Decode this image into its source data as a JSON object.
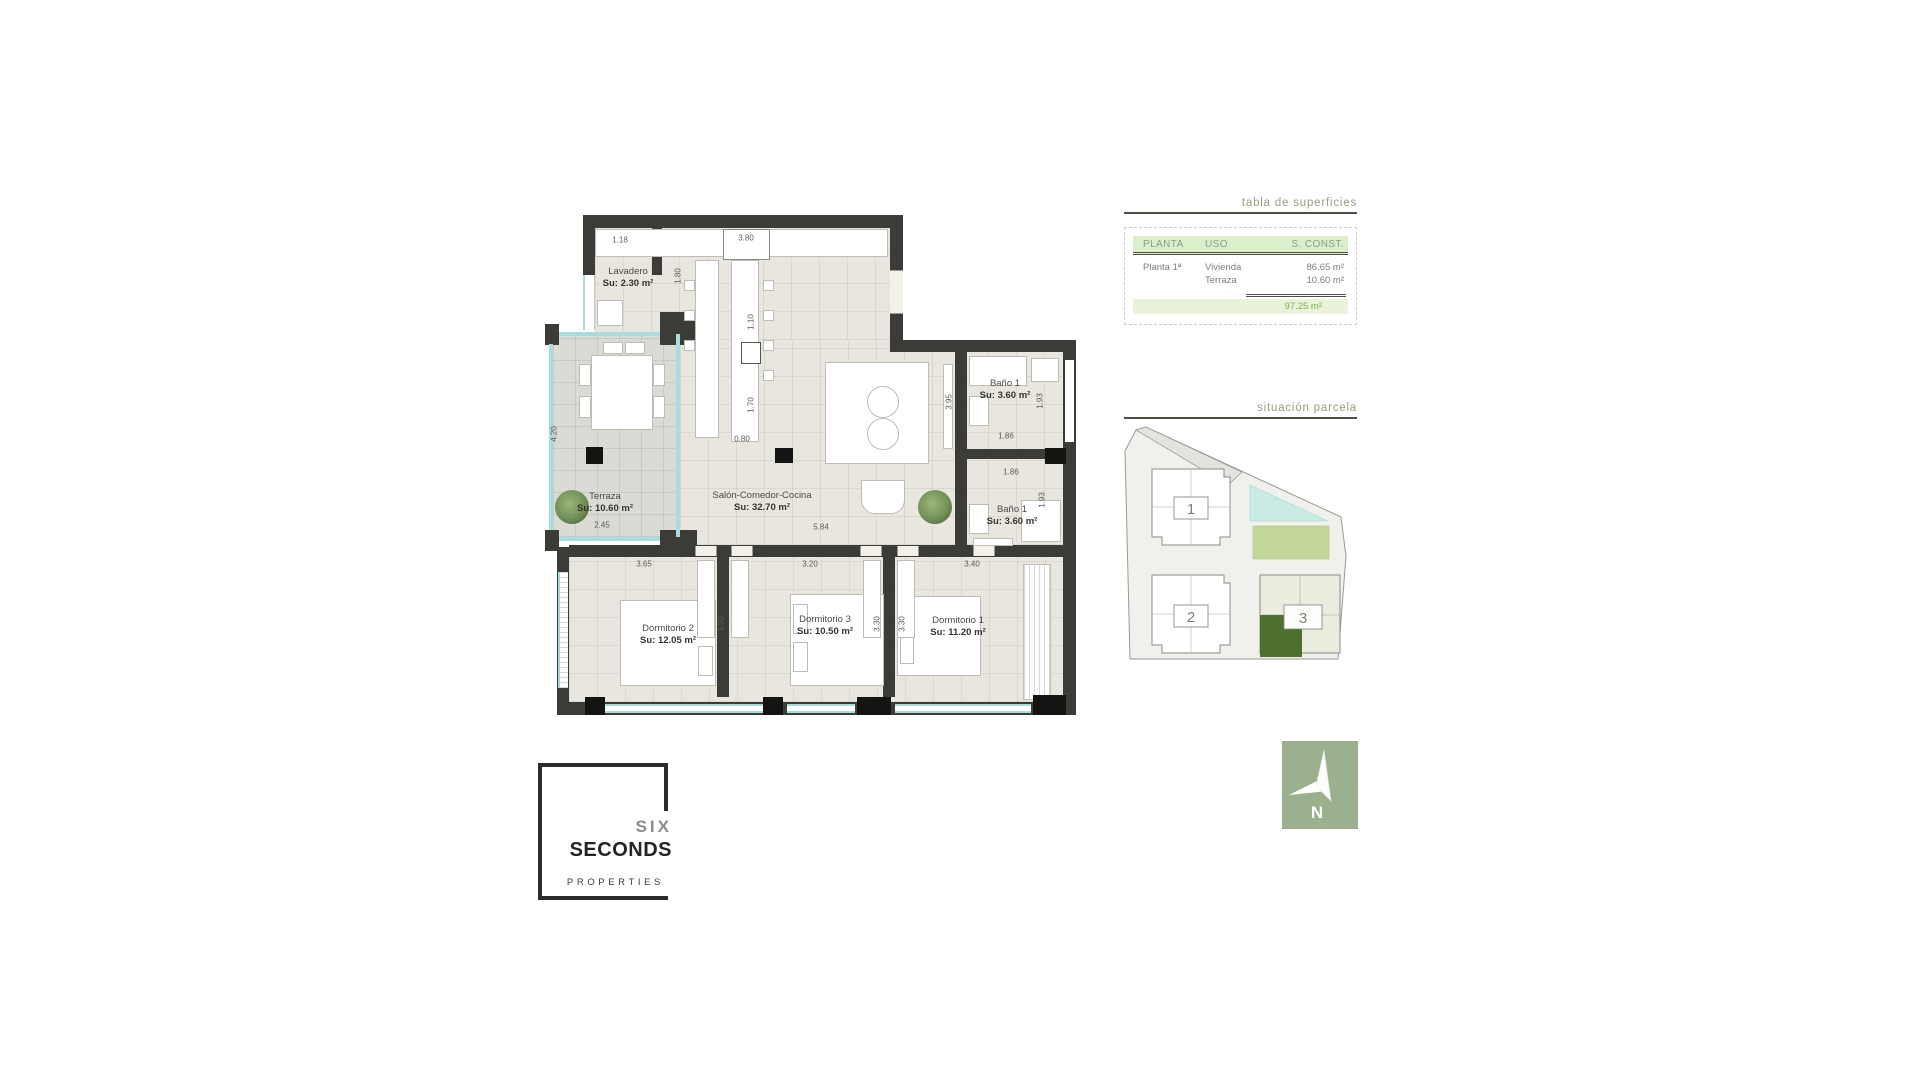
{
  "surfaces_table": {
    "title": "tabla de superficies",
    "headers": [
      "PLANTA",
      "USO",
      "S. CONST."
    ],
    "rows": [
      {
        "planta": "Planta 1ª",
        "uso": "Vivienda",
        "sconst": "86.65 m²"
      },
      {
        "planta": "",
        "uso": "Terraza",
        "sconst": "10.60 m²"
      }
    ],
    "total": "97.25 m²"
  },
  "parcel": {
    "title": "situación parcela",
    "buildings": [
      "1",
      "2",
      "3"
    ]
  },
  "compass": {
    "label": "N"
  },
  "logo": {
    "six": "SIX",
    "seconds": "SECONDS",
    "properties": "PROPERTIES"
  },
  "floorplan": {
    "rooms": [
      {
        "name": "Lavadero",
        "su": "Su: 2.30 m²"
      },
      {
        "name": "Terraza",
        "su": "Su: 10.60 m²"
      },
      {
        "name": "Salón-Comedor-Cocina",
        "su": "Su: 32.70 m²"
      },
      {
        "name": "Baño 1",
        "su": "Su: 3.60 m²"
      },
      {
        "name": "Baño 1",
        "su": "Su: 3.60 m²"
      },
      {
        "name": "Dormitorio 2",
        "su": "Su: 12.05 m²"
      },
      {
        "name": "Dormitorio 3",
        "su": "Su: 10.50 m²"
      },
      {
        "name": "Dormitorio 1",
        "su": "Su: 11.20 m²"
      }
    ],
    "dims": [
      "1.18",
      "3.80",
      "1.80",
      "1.10",
      "1.70",
      "0.80",
      "4.20",
      "2.45",
      "5.84",
      "3.95",
      "1.93",
      "1.86",
      "1.86",
      "1.93",
      "3.65",
      "3.30",
      "3.20",
      "3.30",
      "3.30",
      "3.40"
    ]
  },
  "colors": {
    "wall": "#3b3b38",
    "floor": "#e9e5df",
    "terrace_floor": "#dbdad4",
    "glass": "#a9dcdd",
    "accent_title": "#9b9b82",
    "rule_olive": "#4e4f44",
    "table_header_bg": "#ddefca",
    "total_green": "#7db14d",
    "unit_green": "#4d7030",
    "pool": "#c9ebe4",
    "garden": "#c3d898",
    "compass_bg": "#9cb08e"
  }
}
